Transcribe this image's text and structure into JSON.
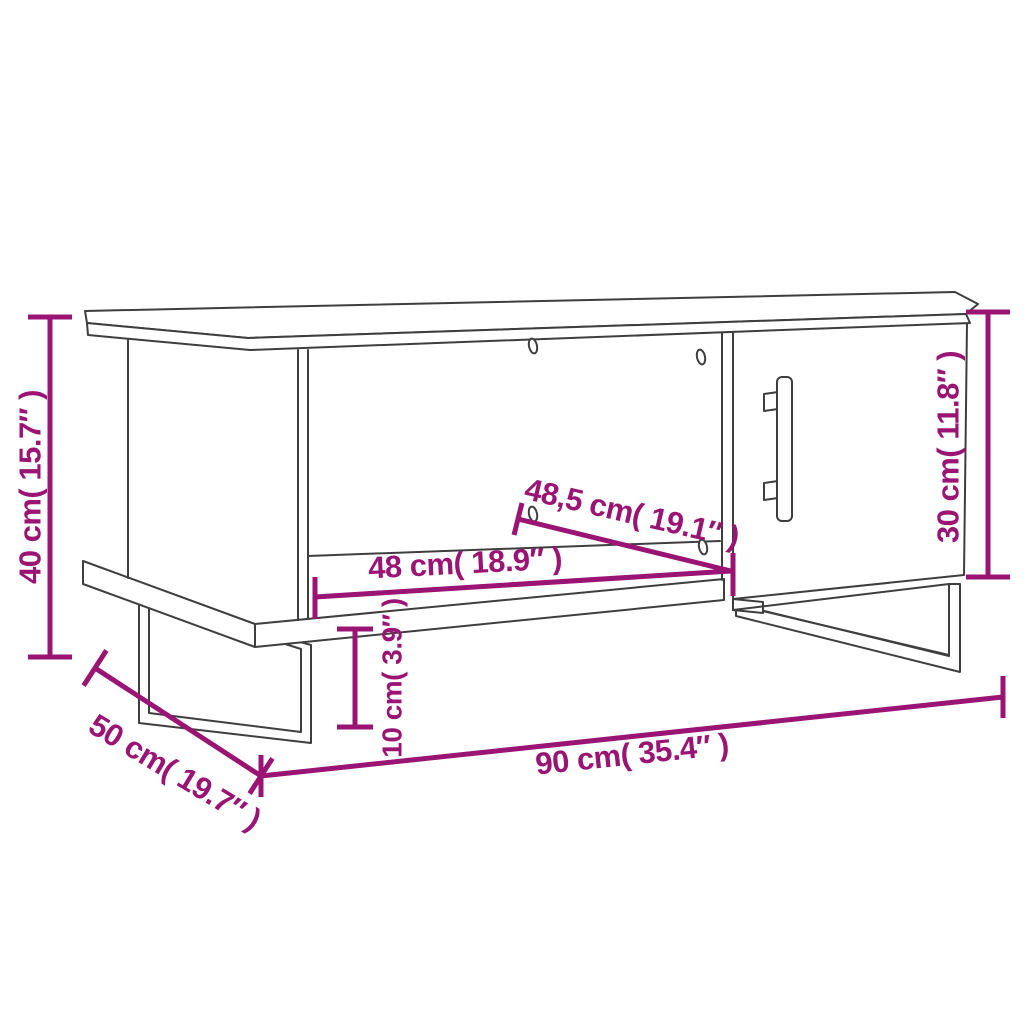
{
  "diagram": {
    "kind": "furniture-dimension-diagram",
    "product": "coffee table with open compartment, cabinet door and sled legs",
    "style": "perspective line drawing"
  },
  "colors": {
    "dimension": "#9a1474",
    "outline": "#3e3e3e",
    "background": "#ffffff"
  },
  "dimensions": {
    "height": {
      "cm": "40",
      "inch": "15.7",
      "label": "40 cm( 15.7″ )"
    },
    "door_height": {
      "cm": "30",
      "inch": "11.8",
      "label": "30 cm( 11.8″ )"
    },
    "clearance": {
      "cm": "10",
      "inch": "3.9",
      "label": "10 cm( 3.9″ )"
    },
    "width": {
      "cm": "90",
      "inch": "35.4",
      "label": "90 cm( 35.4″ )"
    },
    "depth": {
      "cm": "50",
      "inch": "19.7",
      "label": "50 cm( 19.7″ )"
    },
    "compartment_width": {
      "cm": "48",
      "inch": "18.9",
      "label": "48 cm( 18.9″ )"
    },
    "compartment_diagonal": {
      "cm": "48,5",
      "inch": "19.1",
      "label": "48,5 cm( 19.1″ )"
    }
  }
}
